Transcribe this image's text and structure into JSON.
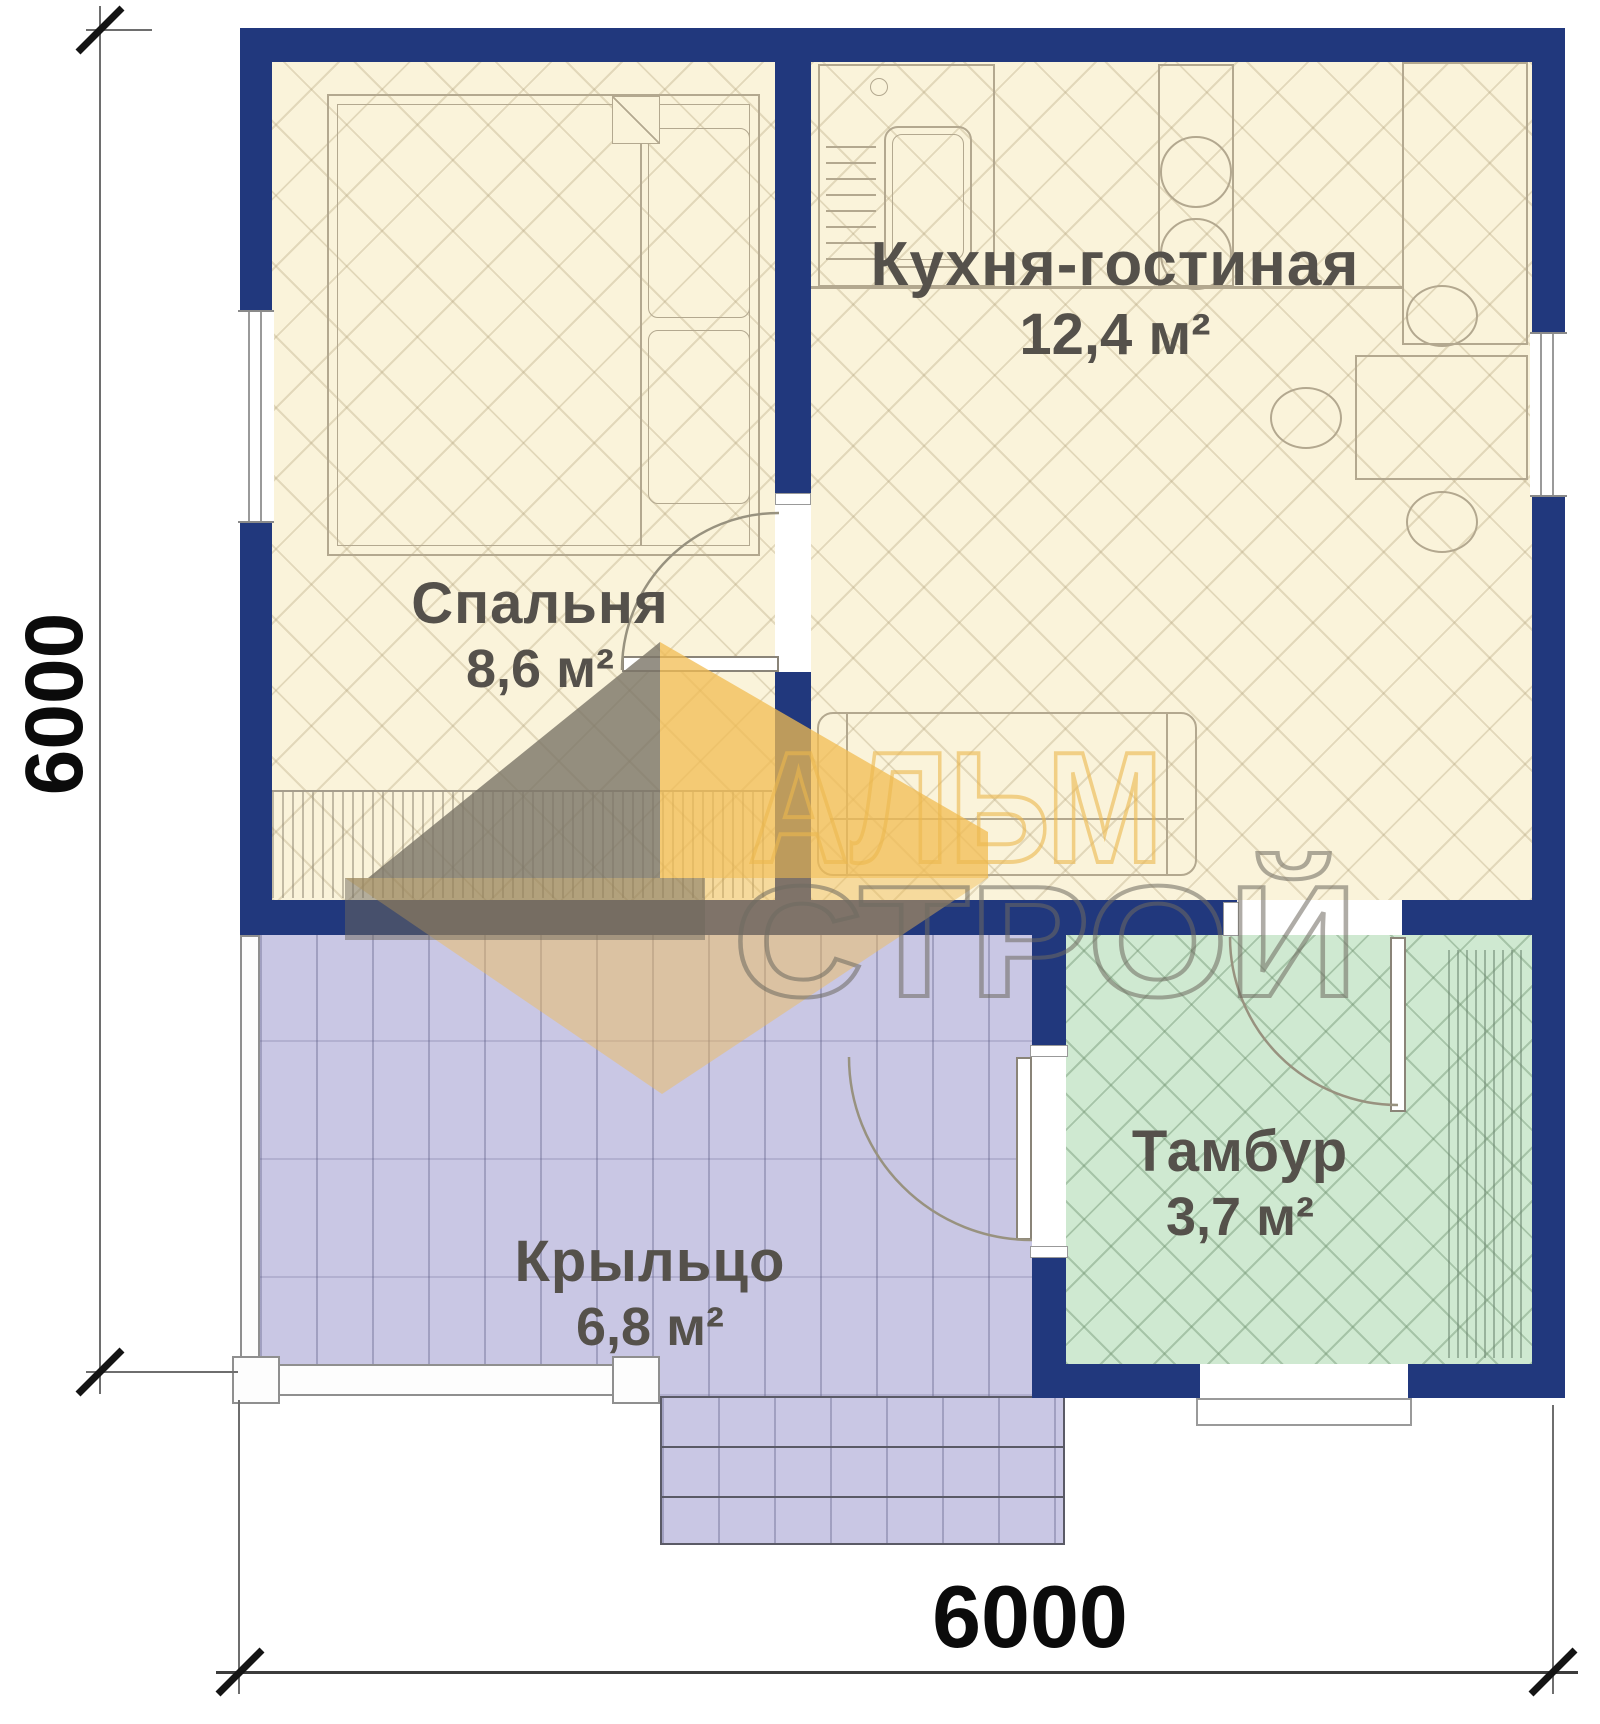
{
  "plan": {
    "rooms": {
      "kitchen": {
        "name": "Кухня-гостиная",
        "area": "12,4 м²"
      },
      "bedroom": {
        "name": "Спальня",
        "area": "8,6 м²"
      },
      "porch": {
        "name": "Крыльцо",
        "area": "6,8 м²"
      },
      "tambour": {
        "name": "Тамбур",
        "area": "3,7 м²"
      }
    },
    "dimensions": {
      "width": "6000",
      "height": "6000"
    },
    "watermark": {
      "line1": "АЛЬМ",
      "line2": "СТРОЙ"
    },
    "colors": {
      "wall": "#21387d",
      "living_floor": "#faf3da",
      "porch_floor": "#c9c7e4",
      "tambour_floor": "#cfe9d1",
      "watermark_yellow": "#f1bc52",
      "watermark_gray": "#6e6a60",
      "label_text": "#55514b",
      "dimension_text": "#0b0b0b"
    }
  }
}
